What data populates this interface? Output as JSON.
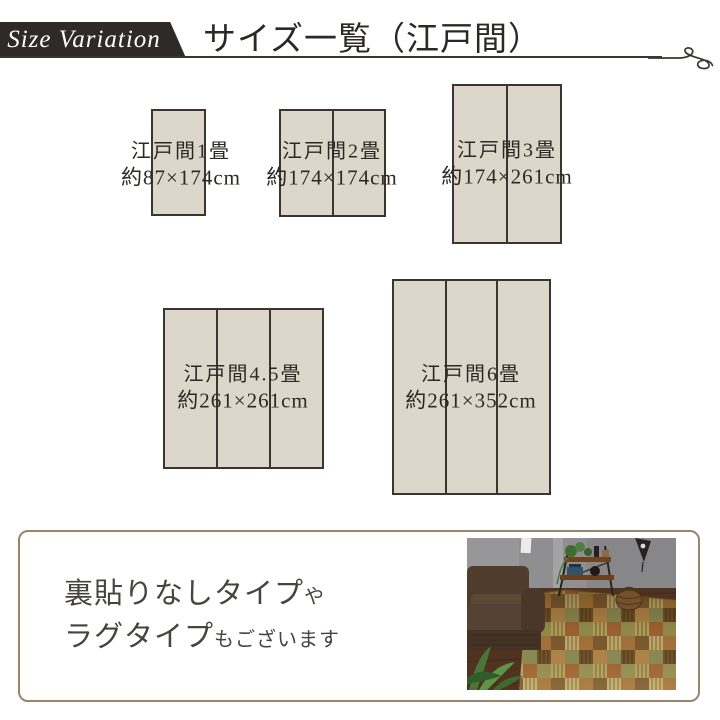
{
  "header": {
    "badge": "Size Variation",
    "title": "サイズ一覧（江戸間）"
  },
  "sizes": [
    {
      "name": "江戸間1畳",
      "dimensions": "約87×174cm",
      "panels": 1
    },
    {
      "name": "江戸間2畳",
      "dimensions": "約174×174cm",
      "panels": 2
    },
    {
      "name": "江戸間3畳",
      "dimensions": "約174×261cm",
      "panels": 2
    },
    {
      "name": "江戸間4.5畳",
      "dimensions": "約261×261cm",
      "panels": 3
    },
    {
      "name": "江戸間6畳",
      "dimensions": "約261×352cm",
      "panels": 3
    }
  ],
  "footer_note": {
    "line1_main": "裏貼りなしタイプ",
    "line1_small": "や",
    "line2_main": "ラグタイプ",
    "line2_small": "もございます"
  },
  "colors": {
    "band_bg": "#2e2a27",
    "mat_fill": "#ddd6ca",
    "mat_border": "#3a3531",
    "note_border": "#97856d",
    "text_dark": "#2c2925"
  }
}
